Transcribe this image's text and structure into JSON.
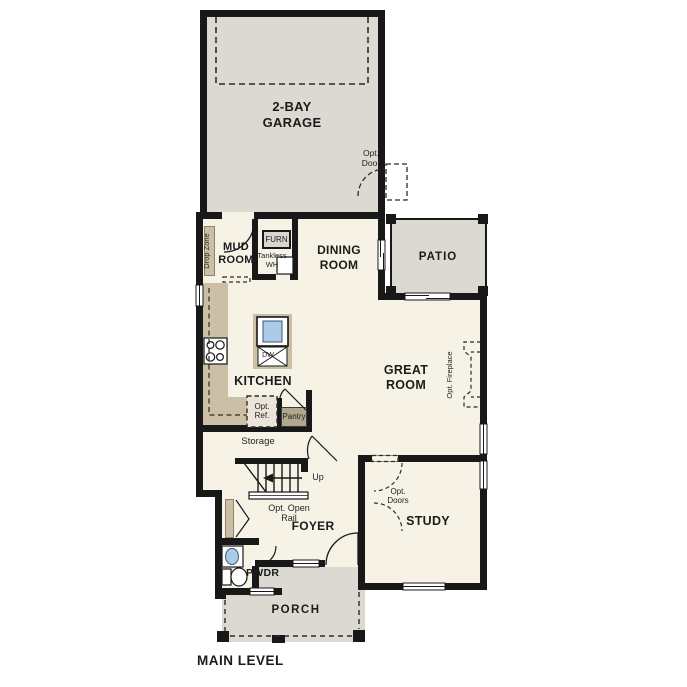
{
  "plan_title": "MAIN LEVEL",
  "rooms": {
    "garage": "2-BAY GARAGE",
    "mud_room": "MUD ROOM",
    "dining_room": "DINING ROOM",
    "patio": "PATIO",
    "kitchen": "KITCHEN",
    "great_room": "GREAT ROOM",
    "storage": "Storage",
    "foyer": "FOYER",
    "study": "STUDY",
    "powder_room": "PWDR",
    "porch": "PORCH"
  },
  "annotations": {
    "drop_zone": "Drop Zone",
    "furnace": "FURN",
    "tankless_water_heater": "Tankless WH",
    "optional_door": "Opt. Door",
    "optional_refrigerator": "Opt. Ref.",
    "pantry": "Pantry",
    "dishwasher": "DW",
    "optional_fireplace": "Opt. Fireplace",
    "stairs_up": "Up",
    "optional_open_rail": "Opt. Open Rail",
    "optional_doors": "Opt. Doors"
  },
  "colors": {
    "wall": "#181818",
    "floor": "#f7f2e6",
    "concrete": "#dcd9d2",
    "counter": "#cbbfa6",
    "cabinet_dark": "#b2a78c",
    "sink_blue": "#a9cae8"
  }
}
